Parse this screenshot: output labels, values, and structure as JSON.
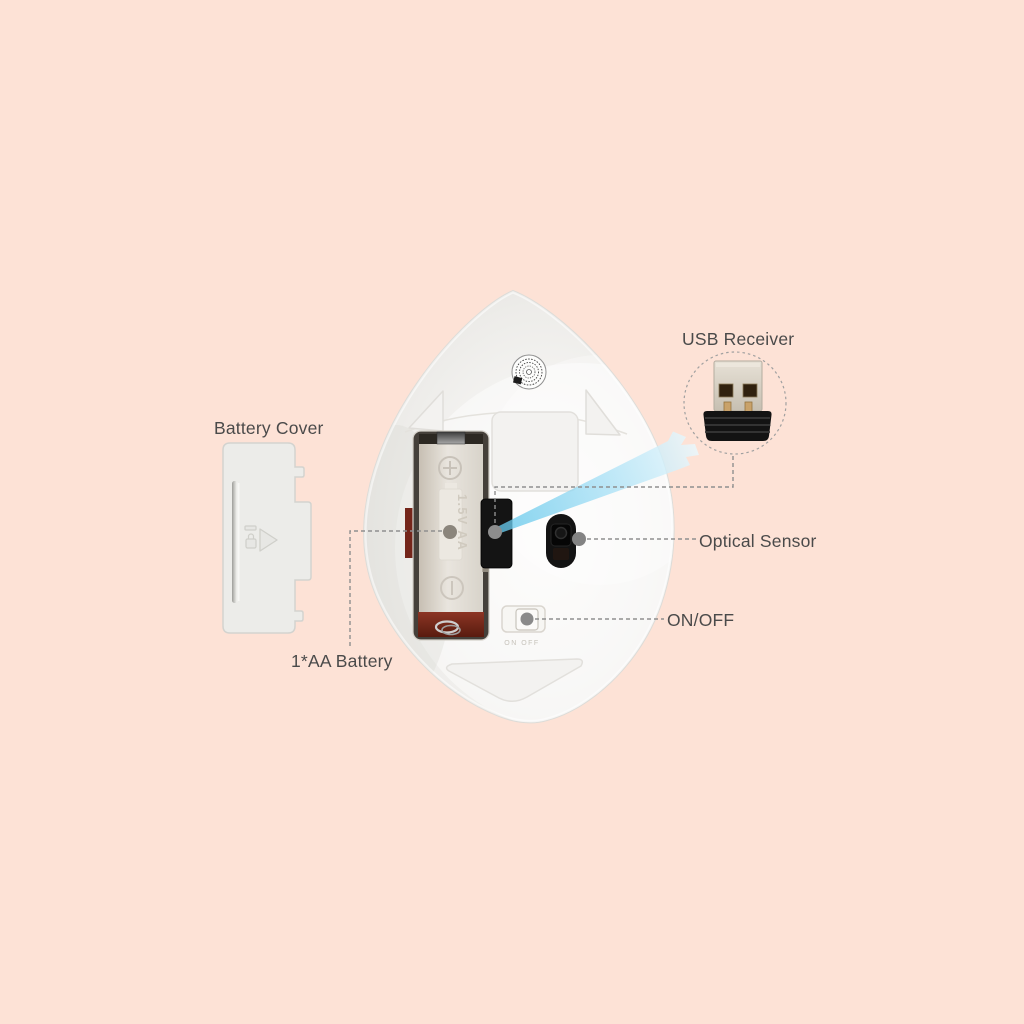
{
  "title": "Wireless mouse bottom view annotated diagram",
  "labels": {
    "usb_receiver": "USB Receiver",
    "battery_cover": "Battery Cover",
    "optical_sensor": "Optical Sensor",
    "on_off": "ON/OFF",
    "aa_battery": "1*AA Battery"
  },
  "device": {
    "battery_emboss": "1.5V AA",
    "switch_emboss": "ON OFF"
  },
  "colors": {
    "background": "#fde2d6",
    "mouse_body": "#f1f0ee",
    "beam_blue": "#7fd0ee",
    "black_parts": "#141414",
    "battery_red": "#72281a",
    "callout_line": "#8f8f8f",
    "label_text": "#4a4a4a",
    "cover_fill": "#ecece9"
  }
}
